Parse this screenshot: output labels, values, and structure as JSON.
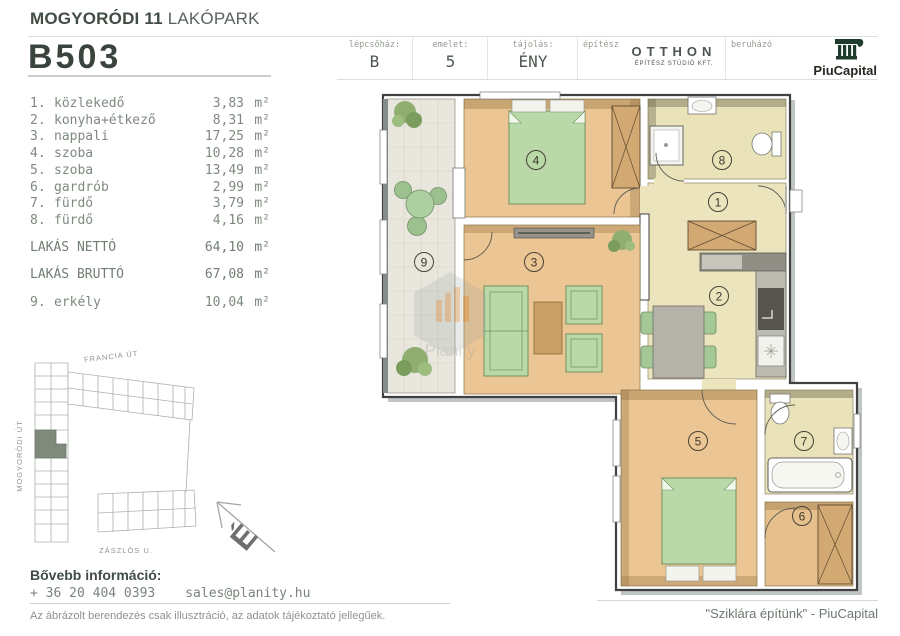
{
  "header": {
    "title_bold": "MOGYORÓDI 11",
    "title_light": " LAKÓPARK",
    "unit_code": "B503",
    "info": {
      "staircase_label": "lépcsőház:",
      "staircase_value": "B",
      "floor_label": "emelet:",
      "floor_value": "5",
      "orientation_label": "tájolás:",
      "orientation_value": "ÉNY",
      "architect_label": "építész",
      "architect_name": "OTTHON",
      "architect_sub": "ÉPÍTÉSZ STÚDIÓ KFT.",
      "developer_label": "beruházó",
      "developer_name": "PiuCapital"
    }
  },
  "area_unit": "m²",
  "rooms": [
    {
      "num": "1.",
      "name": "közlekedő",
      "area": "3,83"
    },
    {
      "num": "2.",
      "name": "konyha+étkező",
      "area": "8,31"
    },
    {
      "num": "3.",
      "name": "nappali",
      "area": "17,25"
    },
    {
      "num": "4.",
      "name": "szoba",
      "area": "10,28"
    },
    {
      "num": "5.",
      "name": "szoba",
      "area": "13,49"
    },
    {
      "num": "6.",
      "name": "gardrób",
      "area": "2,99"
    },
    {
      "num": "7.",
      "name": "fürdő",
      "area": "3,79"
    },
    {
      "num": "8.",
      "name": "fürdő",
      "area": "4,16"
    }
  ],
  "totals": {
    "net": {
      "label": "LAKÁS NETTÓ",
      "value": "64,10"
    },
    "gross": {
      "label": "LAKÁS BRUTTÓ",
      "value": "67,08"
    }
  },
  "balcony_row": {
    "num": "9.",
    "name": "erkély",
    "area": "10,04"
  },
  "site_map": {
    "streets": [
      "FRANCIA ÚT",
      "MOGYORÓDI ÚT",
      "ZÁSZLÓS U."
    ]
  },
  "compass": {
    "north_letter": "É"
  },
  "plan": {
    "watermark": "Planity",
    "room_numbers": [
      "1",
      "2",
      "3",
      "4",
      "5",
      "6",
      "7",
      "8",
      "9"
    ]
  },
  "contact": {
    "heading": "Bővebb információ:",
    "phone": "+ 36 20 404 0393",
    "email": "sales@planity.hu"
  },
  "disclaimer": "Az ábrázolt berendezés csak illusztráció, az adatok tájékoztató jellegűek.",
  "slogan": "\"Sziklára építünk\" - PiuCapital",
  "colors": {
    "text_green": "#7e8a7e",
    "heading_dark": "#414c44",
    "piucapital_green": "#1e3b2c",
    "floor_wood": "#ebc593",
    "floor_beige": "#ece4bd",
    "floor_khaki": "#eae2b9",
    "furniture_green": "#b9daa8",
    "map_highlight": "#7f8a7d"
  }
}
